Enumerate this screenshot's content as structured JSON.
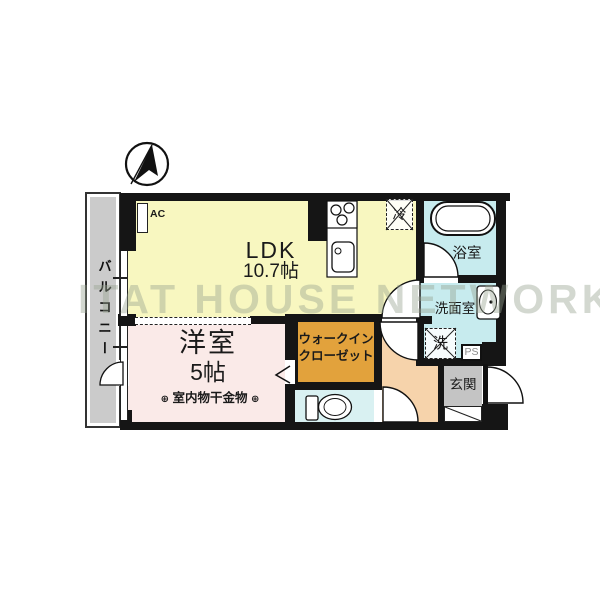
{
  "watermark": {
    "text": "ITAT HOUSE NETWORK"
  },
  "compass": {
    "icon": "north-arrow"
  },
  "balcony": {
    "label": "バルコニー"
  },
  "rooms": {
    "ldk": {
      "name": "LDK",
      "size": "10.7帖"
    },
    "western_room": {
      "name": "洋室",
      "size": "5帖",
      "hanger_note": "室内物干金物",
      "anchor_symbol": "⊕"
    },
    "walk_in_closet": {
      "name_line1": "ウォークイン",
      "name_line2": "クローゼット"
    },
    "bathroom": {
      "name": "浴室"
    },
    "washroom": {
      "name": "洗面室"
    },
    "entrance": {
      "name": "玄関"
    }
  },
  "fixtures": {
    "air_conditioner": "AC",
    "refrigerator": "冷",
    "washing_machine": "洗",
    "pipe_space": "PS"
  },
  "colors": {
    "wall": "#151515",
    "ldk": "#f8f7c0",
    "western": "#faeae8",
    "wic": "#e2a23c",
    "bath": "#c7ebee",
    "toilet": "#d9f1f2",
    "corridor": "#f6d3ab",
    "genkan": "#c4c4c4",
    "balcony": "#cbcbcb"
  }
}
